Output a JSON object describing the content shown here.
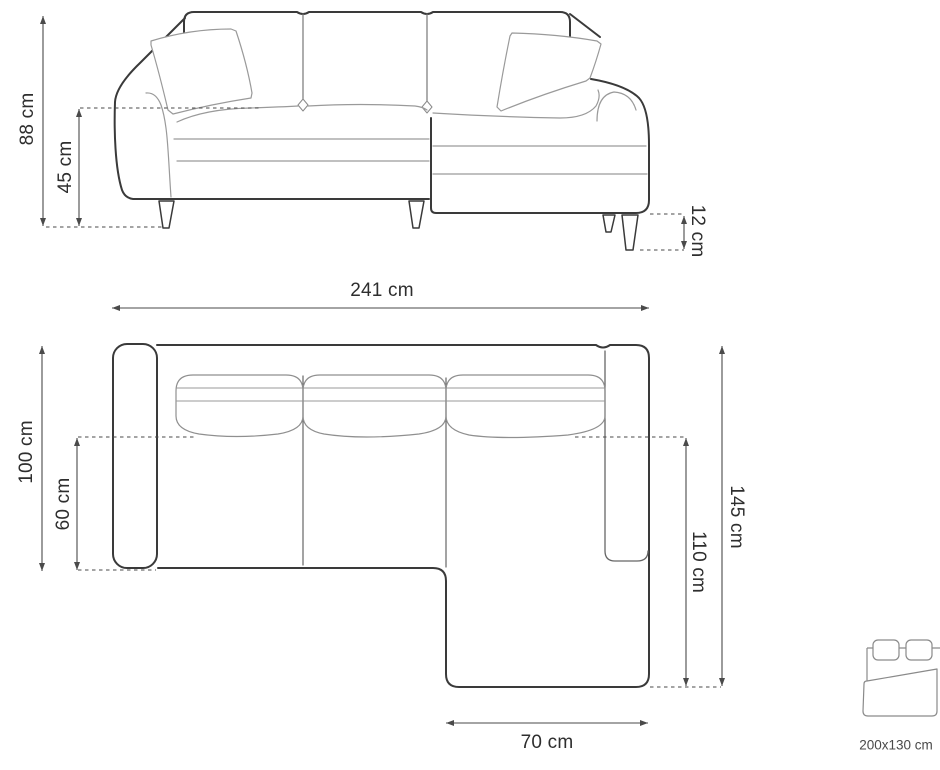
{
  "diagram": {
    "front_view": {
      "total_height": "88 cm",
      "seat_height": "45 cm",
      "leg_height": "12 cm"
    },
    "top_view": {
      "total_width": "241 cm",
      "total_depth": "100 cm",
      "seat_depth": "60 cm",
      "chaise_total_depth": "145 cm",
      "chaise_extension_depth": "110 cm",
      "chaise_width": "70 cm"
    },
    "sleeping_area": {
      "label": "200x130 cm"
    },
    "colors": {
      "outline_dark": "#3a3a3a",
      "outline_light": "#9a9a9a",
      "dimension_line": "#4a4a4a",
      "label_text": "#2e2e2e"
    }
  }
}
